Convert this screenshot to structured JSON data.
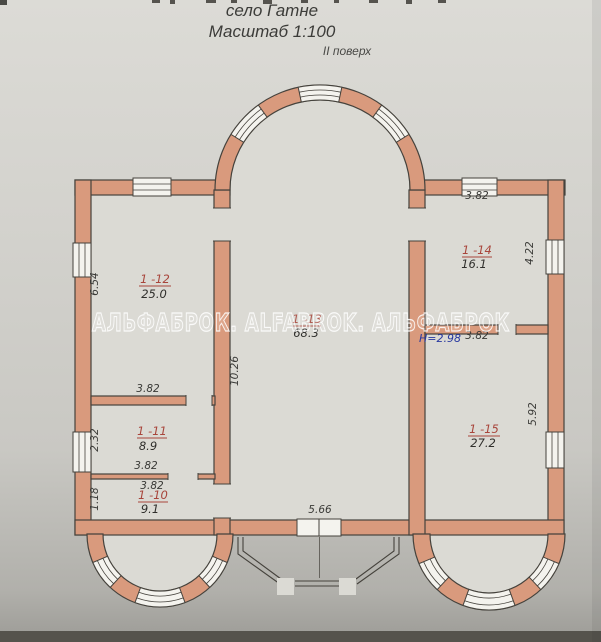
{
  "header": {
    "village": "село Гатне",
    "scale": "Масштаб 1:100",
    "floor": "II поверх"
  },
  "watermark": {
    "text": "АЛЬФАБРОК. ALFABROK. АЛЬФАБРОК"
  },
  "rooms": [
    {
      "id": "1 -12",
      "area": "25.0"
    },
    {
      "id": "1 -11",
      "area": "8.9"
    },
    {
      "id": "1 -10",
      "area": "9.1"
    },
    {
      "id": "1 -13",
      "area": "68.3"
    },
    {
      "id": "1 -14",
      "area": "16.1"
    },
    {
      "id": "1 -15",
      "area": "27.2"
    }
  ],
  "dims": [
    {
      "name": "room-1-12-side-height",
      "value": "6.54"
    },
    {
      "name": "room-1-11-side-height",
      "value": "2.32"
    },
    {
      "name": "room-1-10-side-height",
      "value": "1.18"
    },
    {
      "name": "hall-side-height",
      "value": "10.26"
    },
    {
      "name": "room-1-12-width",
      "value": "3.82"
    },
    {
      "name": "room-1-11-width",
      "value": "3.82"
    },
    {
      "name": "room-1-10-width",
      "value": "3.82"
    },
    {
      "name": "balcony-opening-width",
      "value": "5.66"
    },
    {
      "name": "room-1-14-width-top",
      "value": "3.82"
    },
    {
      "name": "room-1-15-width-top",
      "value": "3.82"
    },
    {
      "name": "room-1-14-side-height",
      "value": "4.22"
    },
    {
      "name": "room-1-15-side-height",
      "value": "5.92"
    }
  ],
  "height_note": "H=2.98",
  "colors": {
    "wall": "#d99a7d",
    "floor": "#dbdad4",
    "window": "#f4f3ee",
    "line": "#45423c",
    "dimtext": "#3a3a37",
    "roomid": "#a8453b",
    "areatext": "#2f2e2b",
    "noteblue": "#2838a0"
  }
}
